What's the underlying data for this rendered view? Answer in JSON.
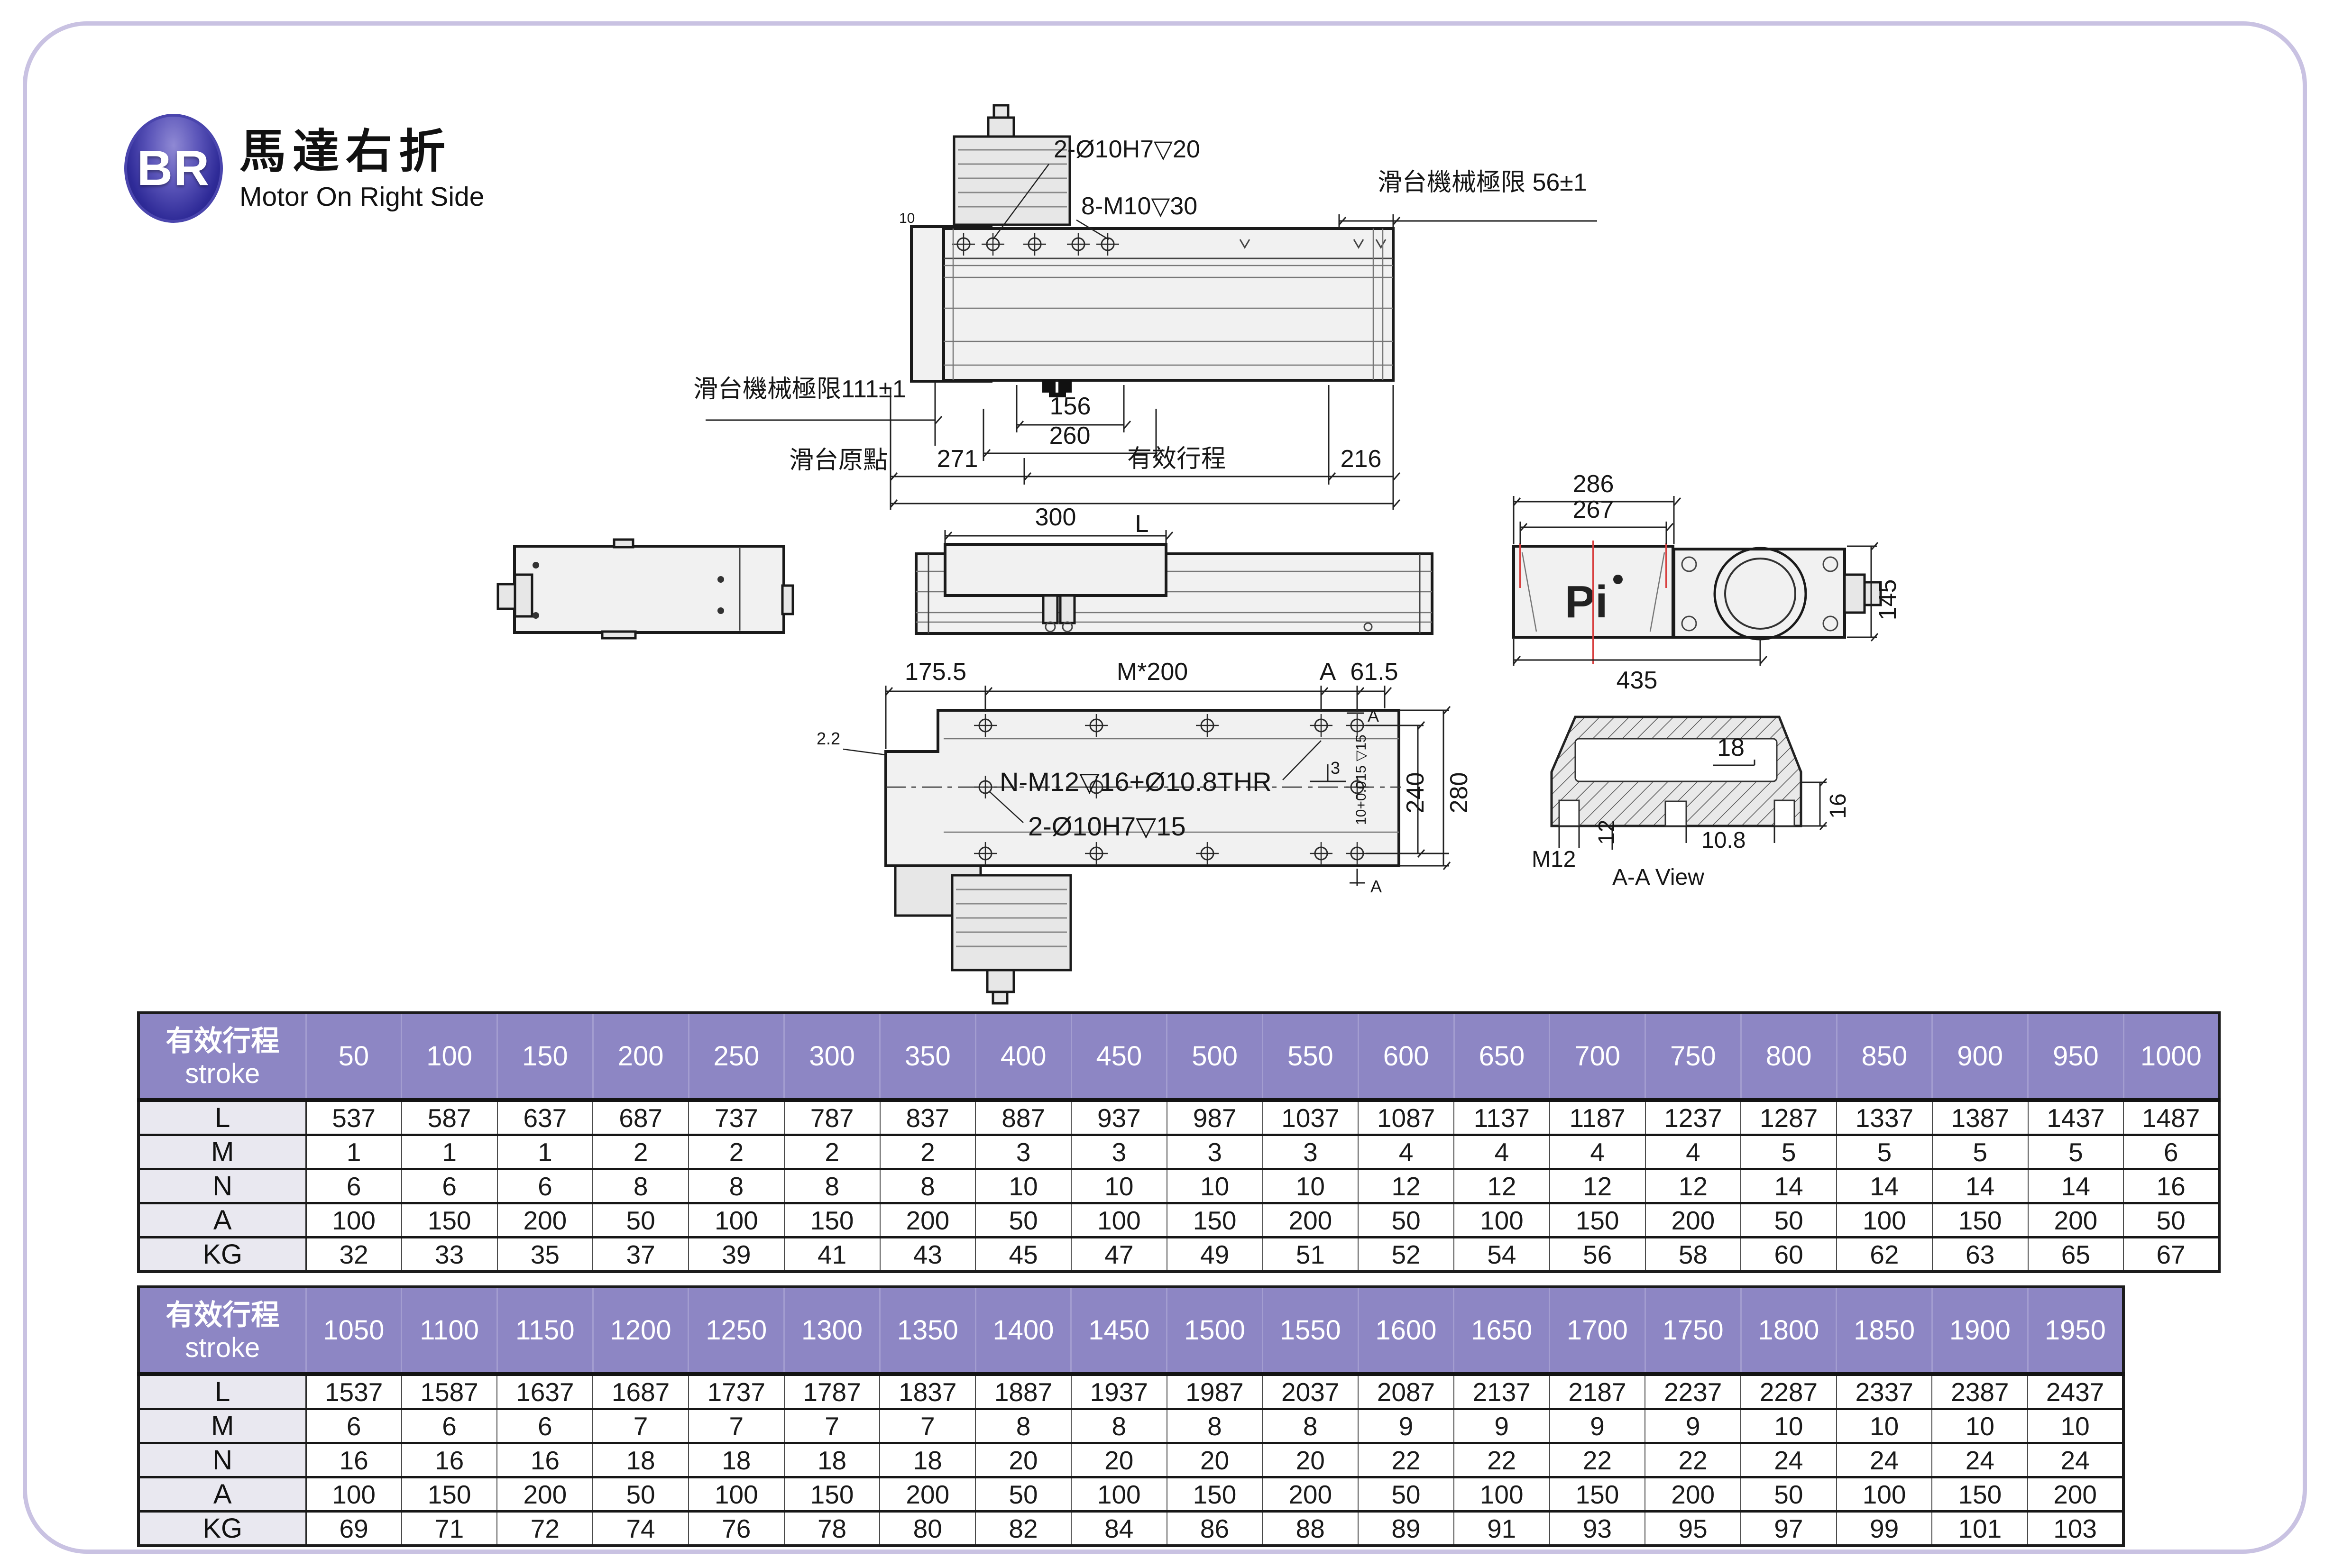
{
  "header": {
    "badge": "BR",
    "title_zh": "馬達右折",
    "title_en": "Motor On Right Side"
  },
  "colors": {
    "badge_blue": "#2e2a97",
    "header_purple": "#8d86c4",
    "row_label_bg": "#e9e8f0",
    "frame_lavender": "#c9c2e2",
    "centerline_red": "#d84040"
  },
  "drawings": {
    "top_view": {
      "hole_callout_1": "2-Ø10H7▽20",
      "hole_callout_2": "8-M10▽30",
      "limit_right": "滑台機械極限 56±1",
      "limit_left": "滑台機械極限111±1",
      "origin": "滑台原點",
      "dim_10": "10",
      "dim_156": "156",
      "dim_260": "260",
      "dim_271": "271",
      "stroke_label": "有效行程",
      "dim_216": "216",
      "dim_L": "L"
    },
    "side_view": {
      "dim_300": "300"
    },
    "end_view": {
      "dim_286": "286",
      "dim_267": "267",
      "dim_435": "435",
      "dim_145": "145",
      "logo": "Pi"
    },
    "bottom_view": {
      "dim_175_5": "175.5",
      "pitch": "M*200",
      "section_a": "A",
      "dim_61_5": "61.5",
      "dim_2_2": "2.2",
      "thread_callout": "N-M12▽16+Ø10.8THR",
      "dowel_callout": "2-Ø10H7▽15",
      "dim_3": "3",
      "tolerance": "10+0.015 ▽15",
      "dim_240": "240",
      "dim_280": "280",
      "section_a_bottom": "A"
    },
    "aa_view": {
      "dim_18": "18",
      "dim_16": "16",
      "dim_m12": "M12",
      "dim_12": "12",
      "dim_10_8": "10.8",
      "caption": "A-A View"
    }
  },
  "tables": [
    {
      "header_zh": "有效行程",
      "header_en": "stroke",
      "columns": [
        "50",
        "100",
        "150",
        "200",
        "250",
        "300",
        "350",
        "400",
        "450",
        "500",
        "550",
        "600",
        "650",
        "700",
        "750",
        "800",
        "850",
        "900",
        "950",
        "1000"
      ],
      "rows": [
        {
          "label": "L",
          "values": [
            "537",
            "587",
            "637",
            "687",
            "737",
            "787",
            "837",
            "887",
            "937",
            "987",
            "1037",
            "1087",
            "1137",
            "1187",
            "1237",
            "1287",
            "1337",
            "1387",
            "1437",
            "1487"
          ]
        },
        {
          "label": "M",
          "values": [
            "1",
            "1",
            "1",
            "2",
            "2",
            "2",
            "2",
            "3",
            "3",
            "3",
            "3",
            "4",
            "4",
            "4",
            "4",
            "5",
            "5",
            "5",
            "5",
            "6"
          ]
        },
        {
          "label": "N",
          "values": [
            "6",
            "6",
            "6",
            "8",
            "8",
            "8",
            "8",
            "10",
            "10",
            "10",
            "10",
            "12",
            "12",
            "12",
            "12",
            "14",
            "14",
            "14",
            "14",
            "16"
          ]
        },
        {
          "label": "A",
          "values": [
            "100",
            "150",
            "200",
            "50",
            "100",
            "150",
            "200",
            "50",
            "100",
            "150",
            "200",
            "50",
            "100",
            "150",
            "200",
            "50",
            "100",
            "150",
            "200",
            "50"
          ]
        },
        {
          "label": "KG",
          "values": [
            "32",
            "33",
            "35",
            "37",
            "39",
            "41",
            "43",
            "45",
            "47",
            "49",
            "51",
            "52",
            "54",
            "56",
            "58",
            "60",
            "62",
            "63",
            "65",
            "67"
          ]
        }
      ]
    },
    {
      "header_zh": "有效行程",
      "header_en": "stroke",
      "columns": [
        "1050",
        "1100",
        "1150",
        "1200",
        "1250",
        "1300",
        "1350",
        "1400",
        "1450",
        "1500",
        "1550",
        "1600",
        "1650",
        "1700",
        "1750",
        "1800",
        "1850",
        "1900",
        "1950"
      ],
      "rows": [
        {
          "label": "L",
          "values": [
            "1537",
            "1587",
            "1637",
            "1687",
            "1737",
            "1787",
            "1837",
            "1887",
            "1937",
            "1987",
            "2037",
            "2087",
            "2137",
            "2187",
            "2237",
            "2287",
            "2337",
            "2387",
            "2437"
          ]
        },
        {
          "label": "M",
          "values": [
            "6",
            "6",
            "6",
            "7",
            "7",
            "7",
            "7",
            "8",
            "8",
            "8",
            "8",
            "9",
            "9",
            "9",
            "9",
            "10",
            "10",
            "10",
            "10"
          ]
        },
        {
          "label": "N",
          "values": [
            "16",
            "16",
            "16",
            "18",
            "18",
            "18",
            "18",
            "20",
            "20",
            "20",
            "20",
            "22",
            "22",
            "22",
            "22",
            "24",
            "24",
            "24",
            "24"
          ]
        },
        {
          "label": "A",
          "values": [
            "100",
            "150",
            "200",
            "50",
            "100",
            "150",
            "200",
            "50",
            "100",
            "150",
            "200",
            "50",
            "100",
            "150",
            "200",
            "50",
            "100",
            "150",
            "200"
          ]
        },
        {
          "label": "KG",
          "values": [
            "69",
            "71",
            "72",
            "74",
            "76",
            "78",
            "80",
            "82",
            "84",
            "86",
            "88",
            "89",
            "91",
            "93",
            "95",
            "97",
            "99",
            "101",
            "103"
          ]
        }
      ]
    }
  ]
}
